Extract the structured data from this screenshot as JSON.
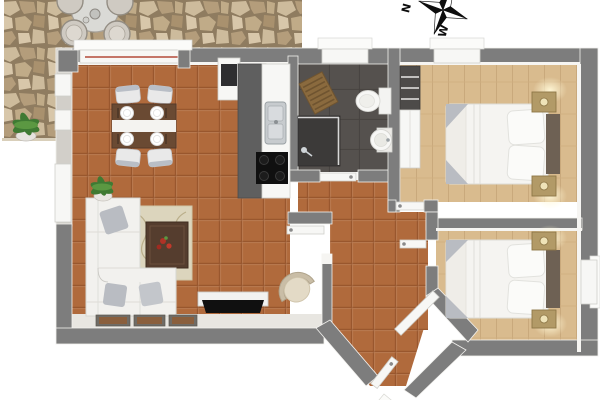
{
  "scene": {
    "title": "apartment-floor-plan-3d-top-view",
    "rooms": [
      "patio",
      "dining-area",
      "kitchen",
      "bathroom",
      "hallway",
      "entry-vestibule",
      "living-room",
      "bedroom-1",
      "bedroom-2"
    ]
  },
  "compass": {
    "north_label": "N",
    "west_label": "W",
    "color": "#0d0d0d"
  },
  "palette": {
    "background": "#ffffff",
    "wall_outer": "#7d7d7d",
    "wall_patio_side": "#d2cfc9",
    "floor_tile": "#b06a3c",
    "floor_tile_line": "#99572e",
    "floor_wood": "#d9bb8e",
    "floor_wood_line": "#c9a97c",
    "floor_bath": "#55514e",
    "floor_bath_line": "#474340",
    "stone_grout": "#8f7c60",
    "stone_a": "#cdbb9c",
    "stone_b": "#c0ab88",
    "stone_c": "#b49d7b",
    "stone_d": "#d8c7aa",
    "stone_e": "#a9916e",
    "furniture_white": "#f2f1ee",
    "counter_dark": "#5f5f5f",
    "cooktop_black": "#101010",
    "table_wood": "#6a4a33",
    "headboard": "#6e6154",
    "nightstand": "#b29a67",
    "cushion_gray": "#b9bcc2",
    "plant_green": "#3f7a33",
    "flower_red": "#b03226",
    "curtain_rail_red": "#b34a3a",
    "lamp_glow": "#fff7d6"
  },
  "furniture": {
    "patio": [
      "round-table",
      "rattan-chairs",
      "kettle",
      "potted-plant"
    ],
    "dining_area": [
      "dark-wood-table",
      "white-runner",
      "four-place-settings",
      "four-chairs"
    ],
    "kitchen": [
      "tall-cabinet-with-oven",
      "dark-counter",
      "worktop-with-sink",
      "cooktop"
    ],
    "bathroom": [
      "shower-cabin",
      "toilet",
      "pedestal-sink",
      "wooden-bath-mat",
      "window"
    ],
    "living_room": [
      "l-shaped-sofa",
      "gray-cushions",
      "area-rug",
      "coffee-table-with-red-flowers",
      "tv-sideboard",
      "flat-tv",
      "wicker-armchair",
      "potted-plant",
      "three-floor-mats"
    ],
    "bedroom_1": [
      "double-bed",
      "pillows",
      "headboard",
      "two-nightstands-with-lamps",
      "wardrobe",
      "shelf-unit",
      "window"
    ],
    "bedroom_2": [
      "double-bed",
      "pillows",
      "headboard",
      "two-nightstands-with-lamps",
      "window"
    ],
    "entry": [
      "front-door",
      "interior-doors"
    ]
  }
}
